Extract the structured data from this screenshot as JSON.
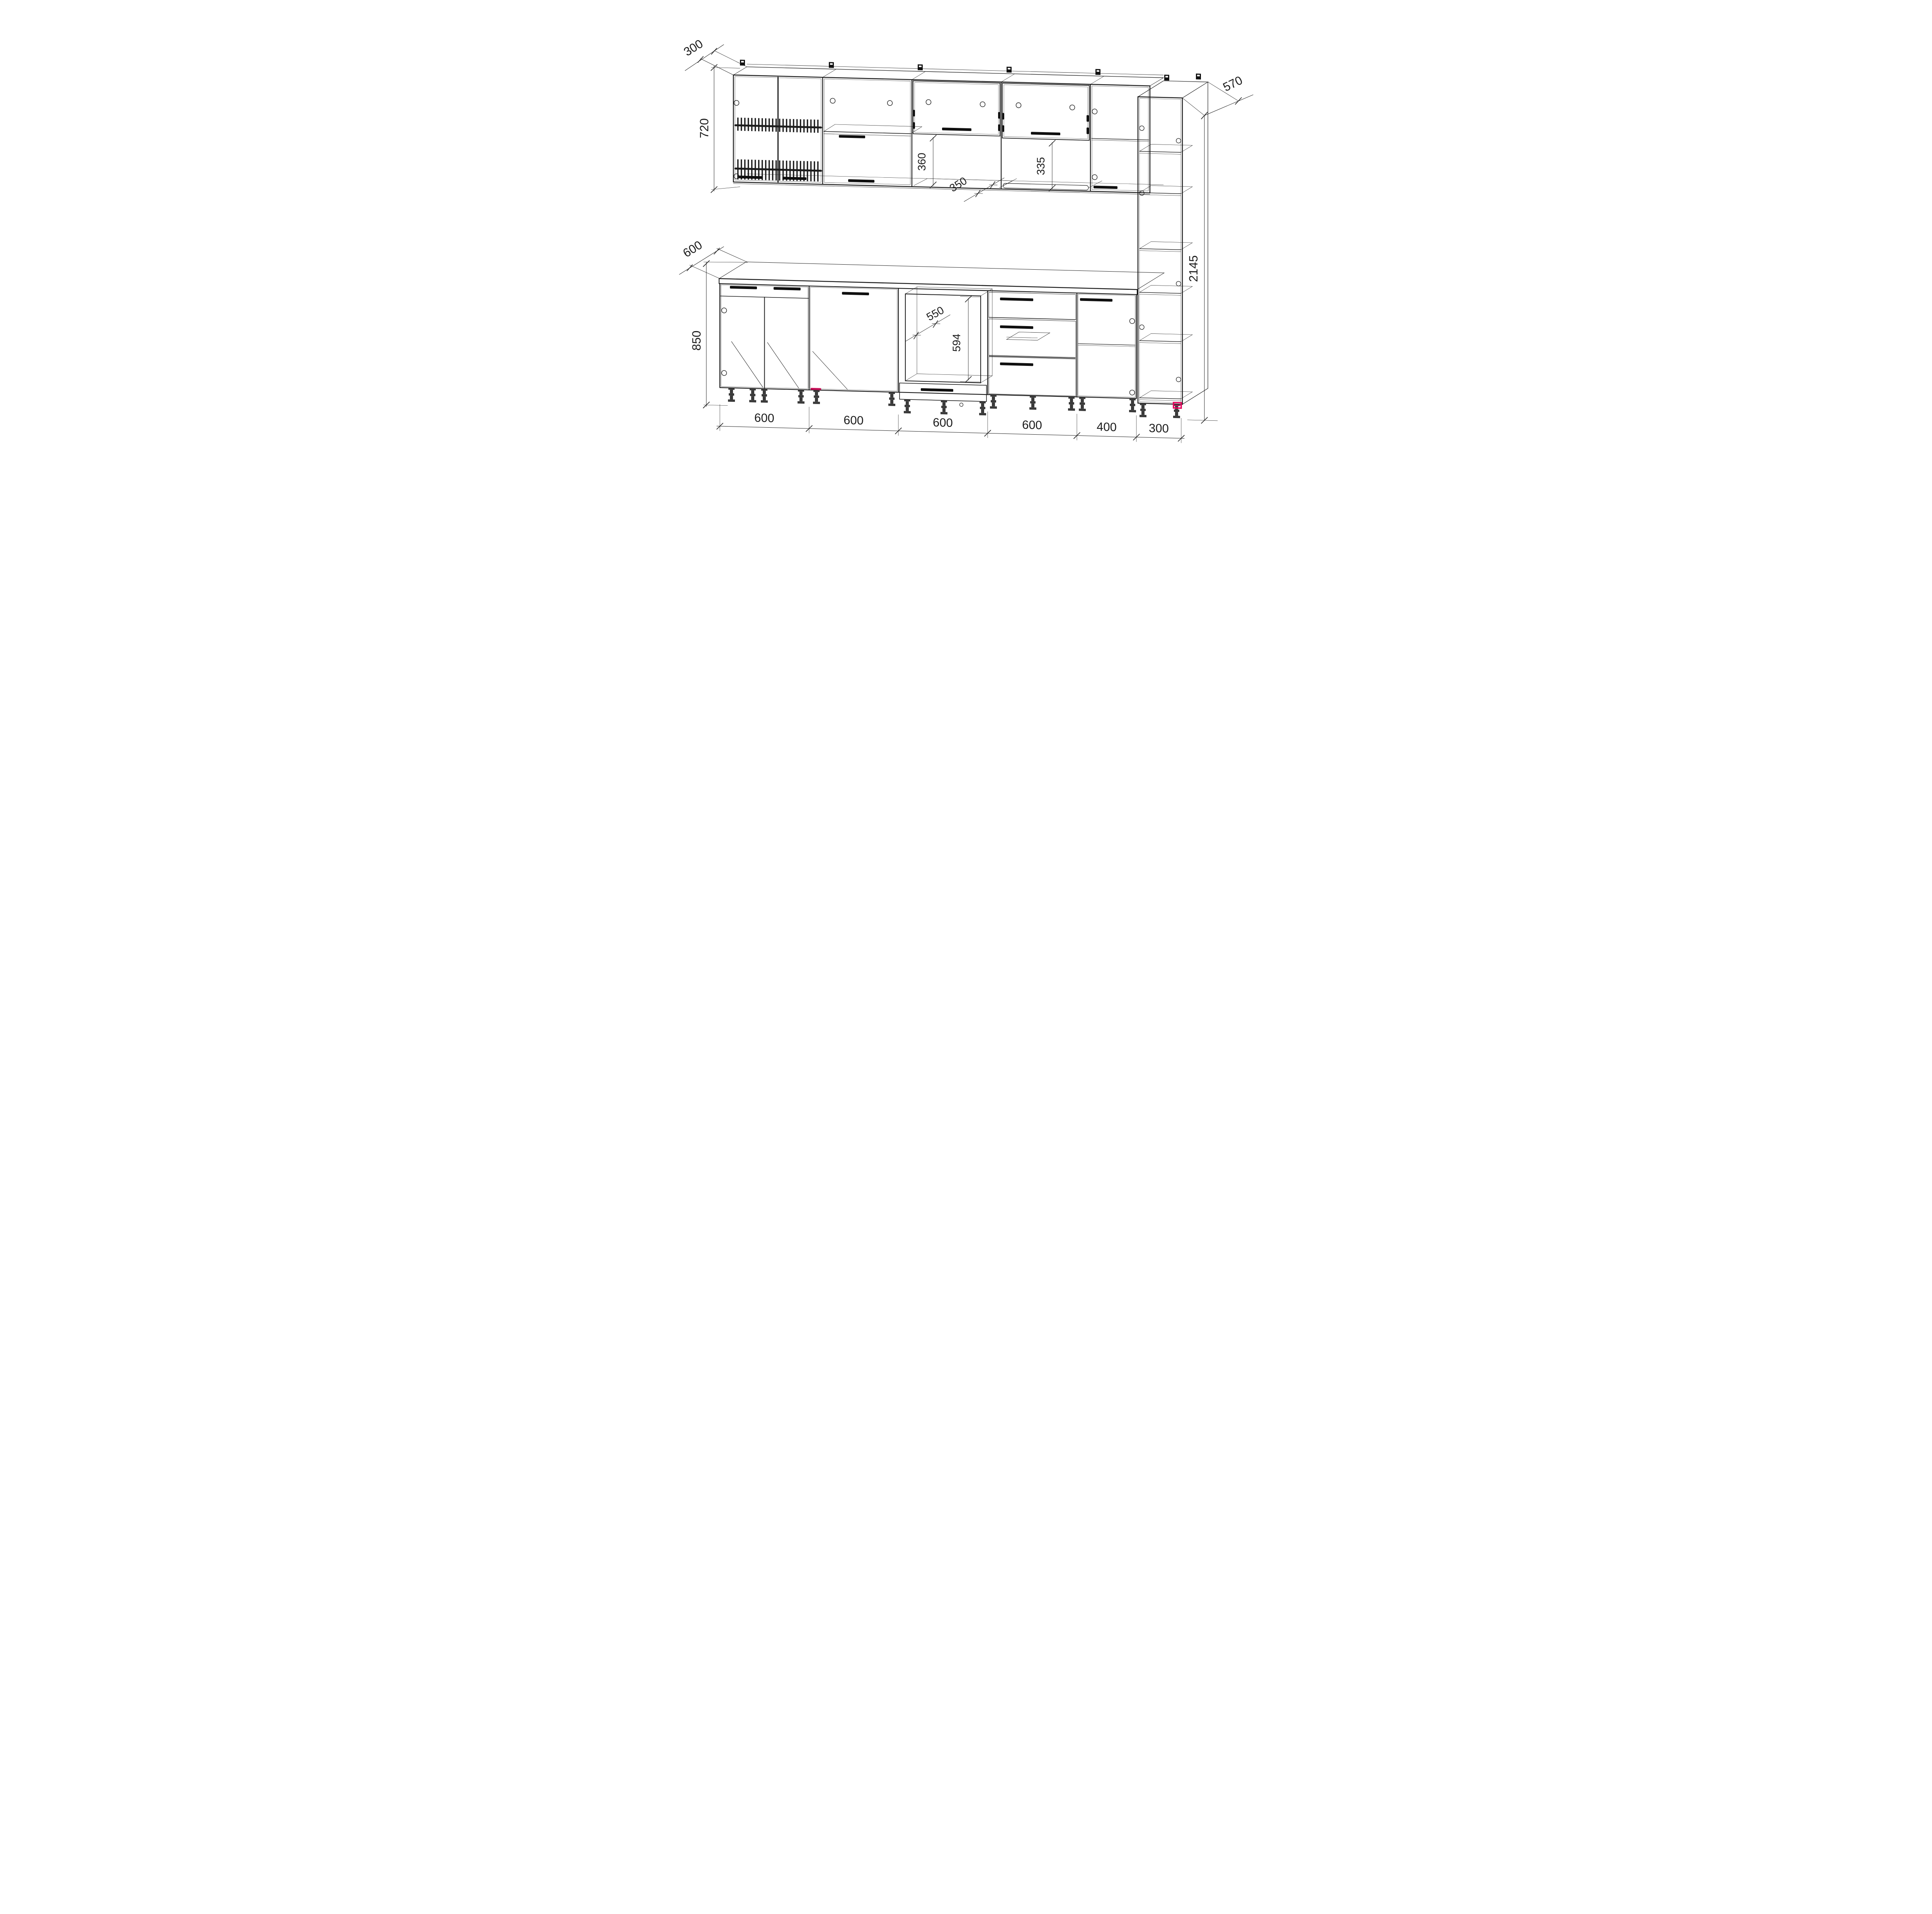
{
  "drawing": {
    "kind": "kitchen-cabinet-set-technical-drawing",
    "dims": {
      "upper_depth": "300",
      "upper_height": "720",
      "base_depth": "600",
      "base_height": "850",
      "tall_depth": "570",
      "tall_height": "2145",
      "u3_niche_height": "360",
      "u4_niche_depth": "350",
      "u4_niche_height": "335",
      "oven_niche_depth": "550",
      "oven_niche_height": "594",
      "module_widths": [
        "600",
        "600",
        "600",
        "600",
        "400",
        "300"
      ]
    },
    "colors": {
      "line": "#1c1c1c",
      "accent_pink": "#e4005a",
      "background": "#ffffff"
    }
  }
}
